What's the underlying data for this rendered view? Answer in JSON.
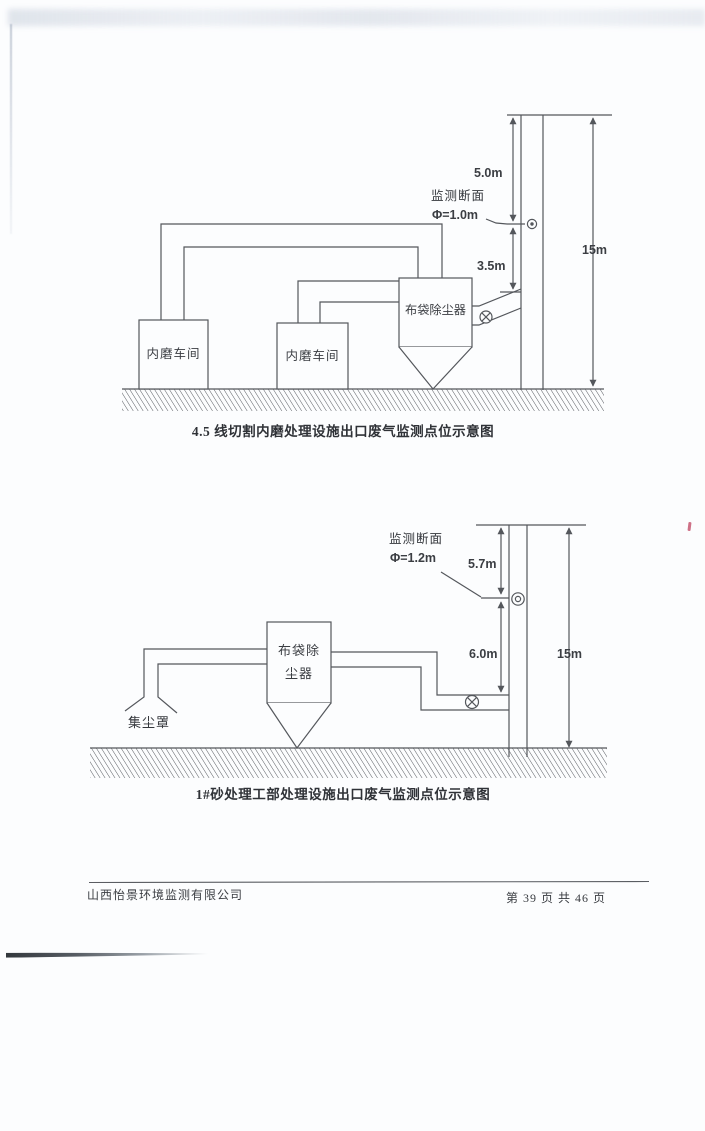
{
  "page": {
    "colors": {
      "ink": "#54575c",
      "text": "#34373c",
      "red_mark": "#c65872",
      "background": "#fcfdfe"
    }
  },
  "diagram1": {
    "caption": "4.5 线切割内磨处理设施出口废气监测点位示意图",
    "workshop1_label": "内磨车间",
    "workshop2_label": "内磨车间",
    "collector_label": "布袋除尘器",
    "monitor_section_label": "监测断面",
    "diameter_label": "Φ=1.0m",
    "dim_top": "5.0m",
    "dim_mid": "3.5m",
    "dim_stack": "15m"
  },
  "diagram2": {
    "caption": "1#砂处理工部处理设施出口废气监测点位示意图",
    "collector_label_line1": "布袋除",
    "collector_label_line2": "尘器",
    "hood_label": "集尘罩",
    "monitor_section_label": "监测断面",
    "diameter_label": "Φ=1.2m",
    "dim_top": "5.7m",
    "dim_mid": "6.0m",
    "dim_stack": "15m"
  },
  "footer": {
    "company": "山西怡景环境监测有限公司",
    "page_number": "第 39 页 共 46 页"
  }
}
